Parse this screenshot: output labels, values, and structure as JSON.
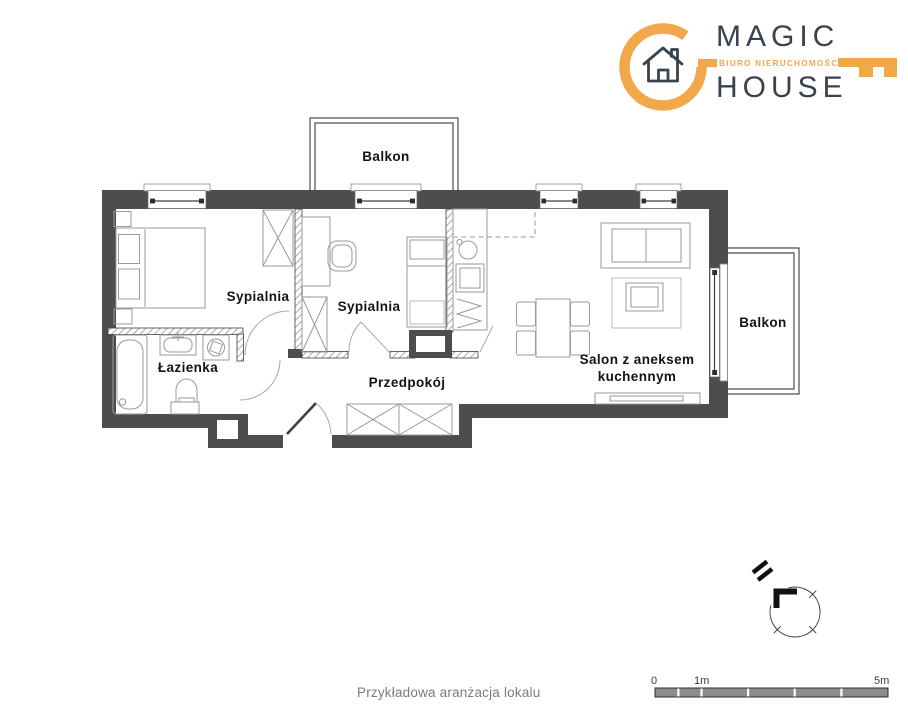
{
  "logo": {
    "name_top": "MAGIC",
    "name_bottom": "HOUSE",
    "tagline": "BIURO NIERUCHOMOŚCI",
    "colors": {
      "orange": "#f2a74b",
      "dark": "#3a434d"
    }
  },
  "plan": {
    "wall_color": "#4d4d4d",
    "labels": {
      "balcony_top": "Balkon",
      "balcony_right": "Balkon",
      "bedroom1": "Sypialnia",
      "bedroom2": "Sypialnia",
      "bathroom": "Łazienka",
      "hall": "Przedpokój",
      "living_line1": "Salon z aneksem",
      "living_line2": "kuchennym"
    }
  },
  "footer": {
    "caption": "Przykładowa aranżacja lokalu"
  },
  "scalebar": {
    "zero": "0",
    "one": "1m",
    "five": "5m",
    "bar_color": "#8c8c8c"
  }
}
